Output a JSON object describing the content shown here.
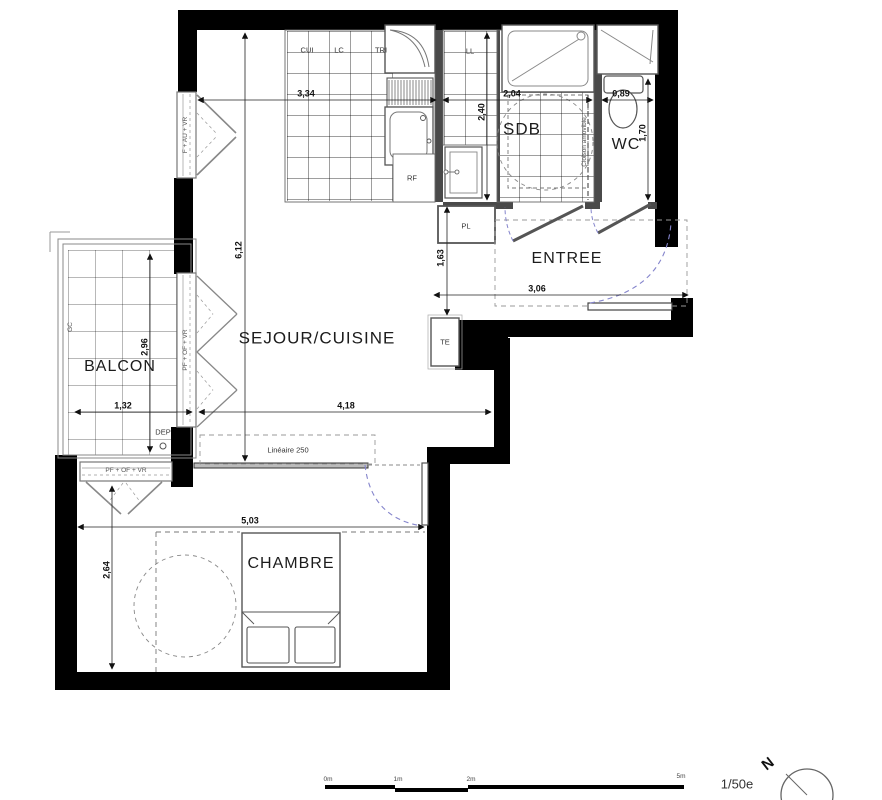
{
  "rooms": {
    "sejour": "SEJOUR/CUISINE",
    "balcon": "BALCON",
    "chambre": "CHAMBRE",
    "entree": "ENTREE",
    "sdb": "SDB",
    "wc": "WC"
  },
  "labels": {
    "cui": "CUI",
    "lc": "LC",
    "tri": "TRI",
    "ll": "LL",
    "rf": "RF",
    "pl": "PL",
    "te": "TE",
    "dep": "DEP",
    "gc": "GC",
    "cloison": "Cloison amovible",
    "lineaire": "Linéaire 250",
    "window_sejour": "F + AU + VR",
    "window_balcon": "PF + OF + VR",
    "window_chambre": "PF + OF + VR"
  },
  "dimensions": {
    "cuisine_width": "3,34",
    "sdb_width": "2,04",
    "wc_width": "0,89",
    "sdb_depth": "2,40",
    "wc_depth": "1,70",
    "sejour_length": "6,12",
    "degagement": "1,63",
    "entree_width": "3,06",
    "balcon_depth": "2,96",
    "balcon_width": "1,32",
    "sejour_width": "4,18",
    "chambre_width": "5,03",
    "chambre_depth": "2,64"
  },
  "scale": {
    "ticks": [
      "0m",
      "1m",
      "2m",
      "5m"
    ],
    "ratio": "1/50e",
    "north": "N"
  },
  "colors": {
    "wall": "#000000",
    "partition": "#4a4a4a",
    "line": "#555555",
    "door_swing": "#8585cc"
  }
}
